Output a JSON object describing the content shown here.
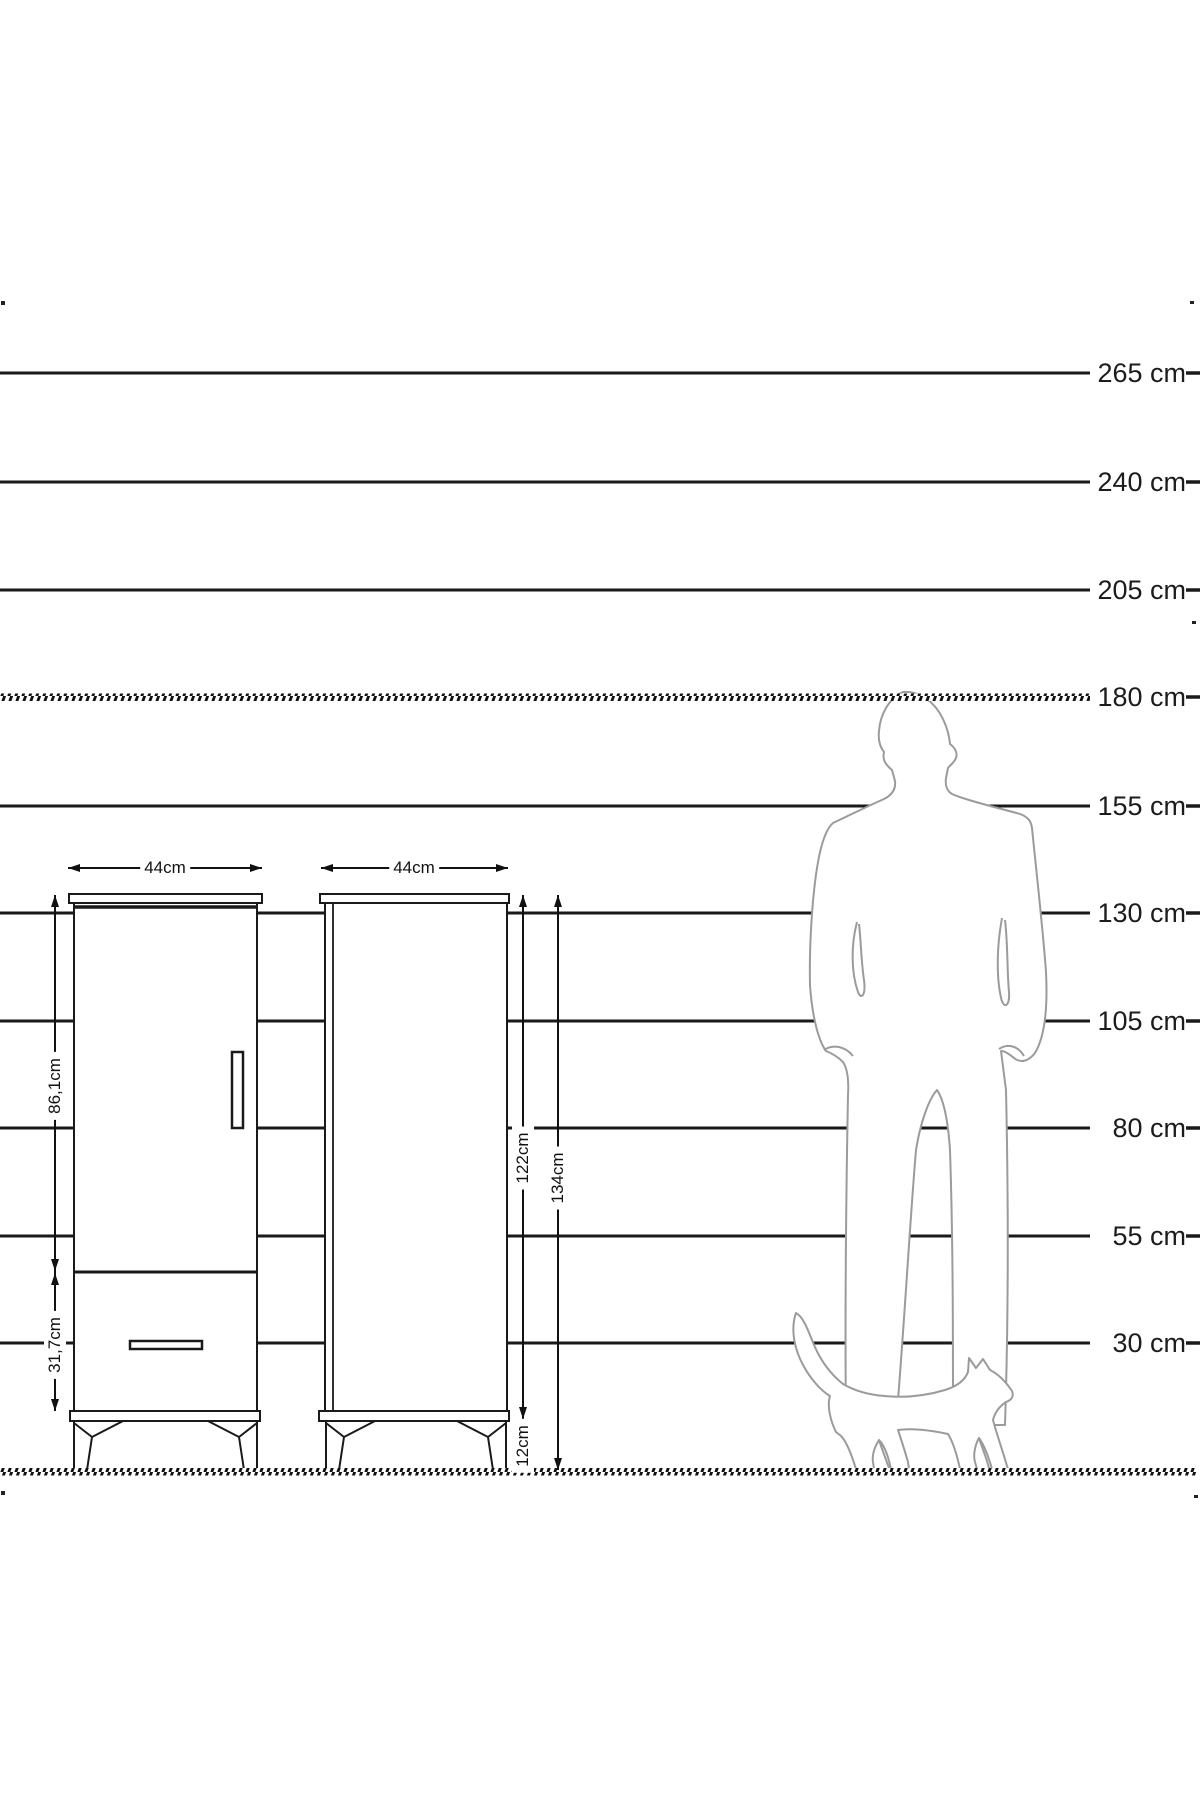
{
  "scale": {
    "labels": [
      "265 cm",
      "240 cm",
      "205 cm",
      "180 cm",
      "155 cm",
      "130 cm",
      "105 cm",
      "80 cm",
      "55 cm",
      "30 cm"
    ]
  },
  "cabinet": {
    "front_width": "44cm",
    "side_width": "44cm",
    "door_height": "86,1cm",
    "drawer_height": "31,7cm",
    "carcass_height": "122cm",
    "total_height": "134cm",
    "leg_height": "12cm"
  },
  "figures": {
    "man": "man-silhouette",
    "cat": "cat-silhouette"
  },
  "colors": {
    "line": "#1a1a1a",
    "silhouette": "#9b9b9b",
    "background": "#ffffff"
  }
}
